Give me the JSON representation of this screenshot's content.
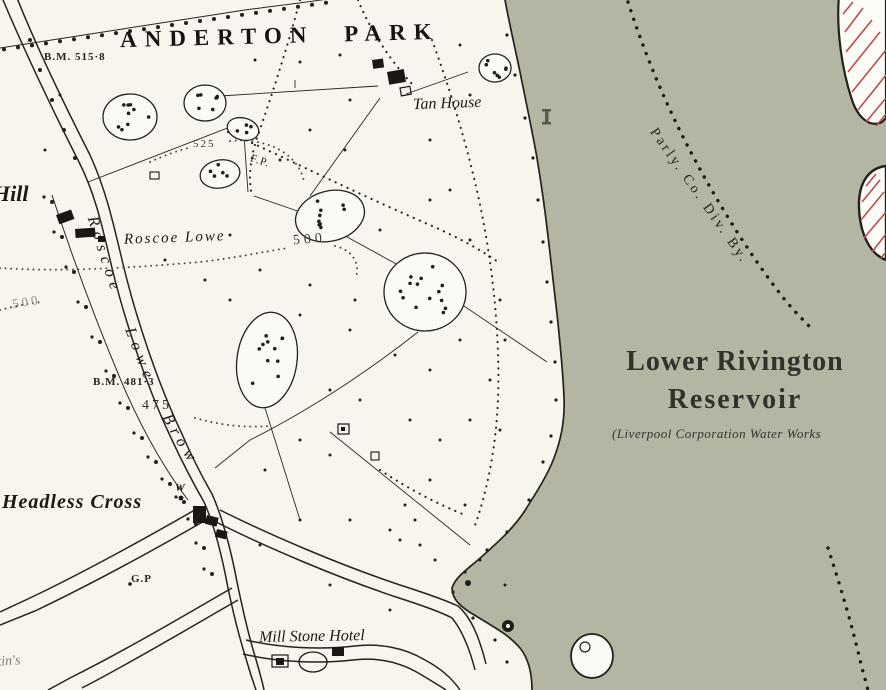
{
  "map": {
    "title": "ANDERTON PARK",
    "labels": {
      "anderton_park": "ANDERTON PARK",
      "bm_515": "B.M. 515·8",
      "tan_house": "Tan House",
      "hill": "Hill",
      "roscoe_lowe": "Roscoe Lowe",
      "contour_525": "525",
      "fp": "F.P.",
      "contour_500": "500",
      "contour_500_left": "500",
      "road_name": "Roscoe Lowe Brow",
      "bm_481": "B.M. 481·3",
      "contour_475": "475",
      "headless_cross": "Headless Cross",
      "well": "W",
      "guide_post": "G.P",
      "mill_stone_hotel": "Mill Stone Hotel",
      "parliamentary_boundary": "Parly. Co. Div. By.",
      "reservoir_line1": "Lower Rivington",
      "reservoir_line2": "Reservoir",
      "reservoir_sub": "(Liverpool Corporation Water Works",
      "partial_bottom_left": "kin's"
    },
    "colors": {
      "water": "#b3b6a2",
      "paper": "#f7f5ed",
      "land": "#fbfaf4",
      "ink": "#1f1c17",
      "hatch_red": "#c24a4e",
      "reservoir_text": "#2f332b"
    }
  }
}
